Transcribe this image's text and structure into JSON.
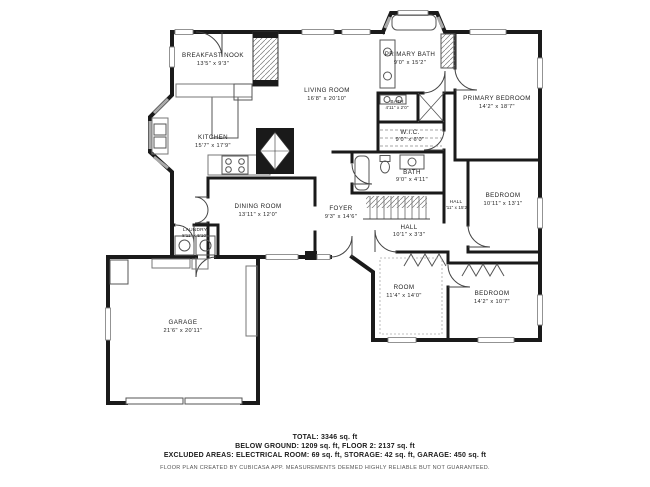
{
  "floor_plan": {
    "rooms": [
      {
        "name": "BREAKFAST NOOK",
        "dims": "13'5\" x 9'3\""
      },
      {
        "name": "LIVING ROOM",
        "dims": "16'8\" x 20'10\""
      },
      {
        "name": "KITCHEN",
        "dims": "15'7\" x 17'9\""
      },
      {
        "name": "PRIMARY BATH",
        "dims": "9'0\" x 15'2\""
      },
      {
        "name": "PRIMARY BEDROOM",
        "dims": "14'2\" x 18'7\""
      },
      {
        "name": "BATH",
        "dims": "4'11\" x 2'0\""
      },
      {
        "name": "W.I.C.",
        "dims": "9'0\" x 6'0\""
      },
      {
        "name": "BATH",
        "dims": "9'0\" x 4'11\""
      },
      {
        "name": "BEDROOM",
        "dims": "10'11\" x 13'1\""
      },
      {
        "name": "HALL",
        "dims": "4'11\" x 15'2\""
      },
      {
        "name": "FOYER",
        "dims": "9'3\" x 14'6\""
      },
      {
        "name": "HALL",
        "dims": "10'1\" x 3'3\""
      },
      {
        "name": "DINING ROOM",
        "dims": "13'11\" x 12'0\""
      },
      {
        "name": "LAUNDRY",
        "dims": "8'11\" x 5'10\""
      },
      {
        "name": "ROOM",
        "dims": "11'4\" x 14'0\""
      },
      {
        "name": "BEDROOM",
        "dims": "14'2\" x 10'7\""
      },
      {
        "name": "GARAGE",
        "dims": "21'6\" x 20'11\""
      }
    ],
    "footer": {
      "total": "TOTAL: 3346 sq. ft",
      "floors": "BELOW GROUND: 1209 sq. ft, FLOOR 2: 2137 sq. ft",
      "excluded": "EXCLUDED AREAS: ELECTRICAL ROOM: 69 sq. ft, STORAGE: 42 sq. ft, GARAGE: 450 sq. ft",
      "disclaimer": "FLOOR PLAN CREATED BY CUBICASA APP. MEASUREMENTS DEEMED HIGHLY RELIABLE BUT NOT GUARANTEED."
    },
    "colors": {
      "wall": "#1a1a1a",
      "window": "#c8c8c8",
      "background": "#ffffff",
      "text": "#222222"
    }
  }
}
